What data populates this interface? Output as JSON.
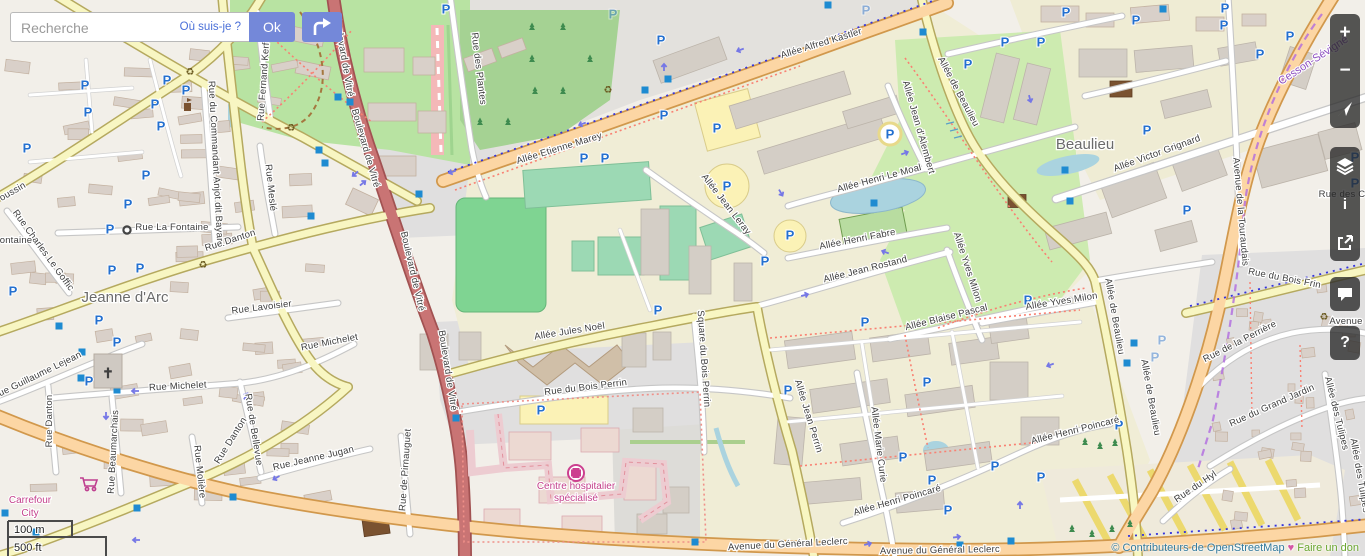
{
  "search": {
    "placeholder": "Recherche",
    "where_am_i": "Où suis-je ?",
    "ok_label": "Ok"
  },
  "controls": {
    "zoom_in": "+",
    "zoom_out": "−",
    "info": "i",
    "query": "?"
  },
  "scale": {
    "metric": "100 m",
    "imperial": "500 ft"
  },
  "attribution": {
    "contributors": "© Contributeurs de OpenStreetMap",
    "heart": "♥",
    "donate": "Faire un don"
  },
  "icons": {
    "church": "✝",
    "recycle": "♻",
    "parking": "P"
  },
  "map": {
    "places": [
      {
        "t": "Beaulieu",
        "x": 1085,
        "y": 149,
        "r": 0,
        "cls": "pl"
      },
      {
        "t": "Jeanne d'Arc",
        "x": 125,
        "y": 302,
        "r": 0,
        "cls": "pl"
      },
      {
        "t": "Cesson-Sévigné",
        "x": 1315,
        "y": 63,
        "r": -33,
        "cls": "plb"
      }
    ],
    "pois": [
      {
        "lines": [
          "Centre hospitalier",
          "spécialisé"
        ],
        "x": 576,
        "y": 489,
        "lh": 12
      },
      {
        "lines": [
          "Carrefour",
          "City"
        ],
        "x": 30,
        "y": 503,
        "lh": 13
      }
    ],
    "streets": [
      [
        "Rue des Plantes",
        476,
        69,
        83
      ],
      [
        "Allée Etienne Marey",
        560,
        151,
        -17
      ],
      [
        "Allée Alfred Kastler",
        822,
        46,
        -17
      ],
      [
        "Allée Jean d'Alembert",
        916,
        128,
        74
      ],
      [
        "Allée Henri Le Moal",
        880,
        181,
        -15
      ],
      [
        "Allée Jean Leray",
        724,
        206,
        52
      ],
      [
        "Allée Henri Fabre",
        858,
        242,
        -11
      ],
      [
        "Allée Jean Rostand",
        866,
        272,
        -14
      ],
      [
        "Allée Blaise Pascal",
        947,
        320,
        -14
      ],
      [
        "Allée Yves Milon",
        965,
        268,
        72
      ],
      [
        "Allée Yves Milon",
        1062,
        304,
        -9
      ],
      [
        "Allée Victor Grignard",
        1158,
        156,
        -20
      ],
      [
        "Allée de Beaulieu",
        956,
        93,
        62
      ],
      [
        "Allée de Beaulieu",
        1112,
        317,
        80
      ],
      [
        "Allée de Beaulieu",
        1148,
        398,
        80
      ],
      [
        "Allée Jules Noël",
        570,
        334,
        -9
      ],
      [
        "Rue du Bois Perrin",
        586,
        390,
        -7
      ],
      [
        "Square du Bois Perrin",
        701,
        359,
        86
      ],
      [
        "Allée Jean Perrin",
        806,
        417,
        73
      ],
      [
        "Allée Marie Curie",
        876,
        445,
        83
      ],
      [
        "Allée Henri Poincaré",
        898,
        503,
        -16
      ],
      [
        "Allée Henri Poincaré",
        1076,
        433,
        -14
      ],
      [
        "Avenue du Général Leclerc",
        788,
        547,
        -3
      ],
      [
        "Avenue du Général Leclerc",
        940,
        553,
        -1
      ],
      [
        "Avenue de la Touraudais",
        1238,
        212,
        85
      ],
      [
        "Rue du Bois Frin",
        1284,
        281,
        11
      ],
      [
        "Rue de la Perrière",
        1241,
        344,
        -27
      ],
      [
        "Rue du Grand Jardin",
        1273,
        408,
        -24
      ],
      [
        "Allée des Tulipes",
        1334,
        414,
        76
      ],
      [
        "Allée des Tulipes",
        1357,
        476,
        80
      ],
      [
        "Rue du Hyl",
        1197,
        489,
        -34
      ],
      [
        "Boulevard de Vitré",
        341,
        57,
        80
      ],
      [
        "Boulevard de Vitré",
        363,
        149,
        74
      ],
      [
        "Boulevard de Vitré",
        410,
        272,
        77
      ],
      [
        "Boulevard de Vitré",
        445,
        371,
        81
      ],
      [
        "Rue La Fontaine",
        172,
        230,
        0
      ],
      [
        "Rue du Commandant Anjot dit Bayard",
        213,
        164,
        87
      ],
      [
        "Rue Meslé",
        268,
        188,
        84
      ],
      [
        "Rue Fernand Kerforne",
        267,
        72,
        -86
      ],
      [
        "Rue Danton",
        231,
        243,
        -18
      ],
      [
        "Rue Danton",
        52,
        421,
        -90
      ],
      [
        "Rue Danton",
        233,
        442,
        -58
      ],
      [
        "Rue Lavoisier",
        262,
        310,
        -7
      ],
      [
        "Rue Michelet",
        330,
        345,
        -11
      ],
      [
        "Rue Michelet",
        178,
        389,
        -3
      ],
      [
        "Rue Guillaume Lejean",
        38,
        378,
        -26
      ],
      [
        "Rue Charles Le Goffic",
        41,
        252,
        54
      ],
      [
        "Rue Beaumarchais",
        116,
        452,
        -87
      ],
      [
        "Rue Molière",
        197,
        472,
        84
      ],
      [
        "Rue de Bellevue",
        251,
        430,
        81
      ],
      [
        "Rue Jeanne Jugan",
        314,
        461,
        -13
      ],
      [
        "Rue de Pirnauguet",
        408,
        470,
        -86
      ],
      [
        "oussin",
        14,
        194,
        -30
      ],
      [
        "ontaine",
        16,
        243,
        0
      ],
      [
        "Rue des C",
        1342,
        197,
        0
      ],
      [
        "Avenue",
        1346,
        324,
        0
      ]
    ],
    "parking": [
      [
        446,
        9
      ],
      [
        661,
        40
      ],
      [
        664,
        115
      ],
      [
        584,
        158
      ],
      [
        605,
        158
      ],
      [
        717,
        128
      ],
      [
        727,
        186
      ],
      [
        790,
        235
      ],
      [
        658,
        310
      ],
      [
        765,
        261
      ],
      [
        541,
        410
      ],
      [
        865,
        322
      ],
      [
        788,
        390
      ],
      [
        927,
        382
      ],
      [
        903,
        457
      ],
      [
        932,
        480
      ],
      [
        995,
        466
      ],
      [
        1041,
        477
      ],
      [
        948,
        510
      ],
      [
        167,
        80
      ],
      [
        186,
        90
      ],
      [
        155,
        104
      ],
      [
        161,
        126
      ],
      [
        146,
        175
      ],
      [
        128,
        204
      ],
      [
        110,
        229
      ],
      [
        112,
        270
      ],
      [
        140,
        268
      ],
      [
        99,
        320
      ],
      [
        117,
        342
      ],
      [
        89,
        381
      ],
      [
        27,
        148
      ],
      [
        85,
        85
      ],
      [
        88,
        112
      ],
      [
        13,
        291
      ],
      [
        968,
        64
      ],
      [
        1005,
        42
      ],
      [
        1041,
        42
      ],
      [
        1147,
        130
      ],
      [
        1187,
        210
      ],
      [
        1066,
        12
      ],
      [
        1136,
        20
      ],
      [
        1225,
        8
      ],
      [
        1224,
        25
      ],
      [
        1290,
        36
      ],
      [
        1260,
        54
      ],
      [
        1355,
        157
      ],
      [
        1355,
        183
      ],
      [
        1119,
        425
      ],
      [
        1028,
        300
      ]
    ],
    "parking_faded": [
      [
        613,
        14
      ],
      [
        866,
        10
      ],
      [
        1162,
        340
      ],
      [
        1155,
        357
      ]
    ],
    "parking_circled": [
      [
        890,
        134
      ]
    ],
    "squares": [
      [
        319,
        150
      ],
      [
        325,
        163
      ],
      [
        419,
        194
      ],
      [
        311,
        216
      ],
      [
        338,
        97
      ],
      [
        350,
        102
      ],
      [
        668,
        79
      ],
      [
        645,
        90
      ],
      [
        828,
        5
      ],
      [
        923,
        32
      ],
      [
        82,
        352
      ],
      [
        117,
        390
      ],
      [
        233,
        497
      ],
      [
        137,
        508
      ],
      [
        5,
        513
      ],
      [
        36,
        532
      ],
      [
        960,
        545
      ],
      [
        1011,
        541
      ],
      [
        1065,
        170
      ],
      [
        1070,
        201
      ],
      [
        1134,
        343
      ],
      [
        1127,
        363
      ],
      [
        1163,
        9
      ],
      [
        456,
        418
      ],
      [
        695,
        542
      ],
      [
        59,
        326
      ],
      [
        81,
        378
      ],
      [
        874,
        203
      ]
    ],
    "arrows": [
      [
        740,
        50,
        160
      ],
      [
        582,
        124,
        160
      ],
      [
        452,
        172,
        160
      ],
      [
        664,
        67,
        -90
      ],
      [
        781,
        193,
        60
      ],
      [
        885,
        252,
        200
      ],
      [
        805,
        295,
        -15
      ],
      [
        135,
        391,
        180
      ],
      [
        106,
        416,
        90
      ],
      [
        246,
        396,
        -60
      ],
      [
        276,
        478,
        150
      ],
      [
        136,
        540,
        180
      ],
      [
        957,
        537,
        -8
      ],
      [
        1020,
        505,
        -90
      ],
      [
        355,
        174,
        140
      ],
      [
        363,
        183,
        -40
      ],
      [
        1030,
        99,
        75
      ],
      [
        868,
        544,
        -15
      ],
      [
        1050,
        365,
        160
      ],
      [
        905,
        153,
        -20
      ]
    ],
    "recycling": [
      [
        190,
        72
      ],
      [
        291,
        128
      ],
      [
        203,
        265
      ],
      [
        608,
        90
      ],
      [
        1324,
        317
      ]
    ],
    "trees": [
      [
        532,
        28
      ],
      [
        563,
        28
      ],
      [
        532,
        60
      ],
      [
        590,
        60
      ],
      [
        535,
        92
      ],
      [
        563,
        92
      ],
      [
        480,
        123
      ],
      [
        508,
        123
      ],
      [
        1085,
        443
      ],
      [
        1100,
        447
      ],
      [
        1115,
        444
      ],
      [
        1072,
        530
      ],
      [
        1092,
        535
      ],
      [
        1112,
        530
      ],
      [
        1130,
        525
      ]
    ]
  },
  "colors": {
    "accent_blue": "#7488d9",
    "link_blue": "#4a6fd8",
    "parking_blue": "#2470cf",
    "marker_blue": "#1e8bd1",
    "poi_magenta": "#c33f8b",
    "donate_green": "#6aa52f",
    "attrib_teal": "#337a9c",
    "trunk_red": "#c97474",
    "primary_orange": "#fcd6a4"
  }
}
